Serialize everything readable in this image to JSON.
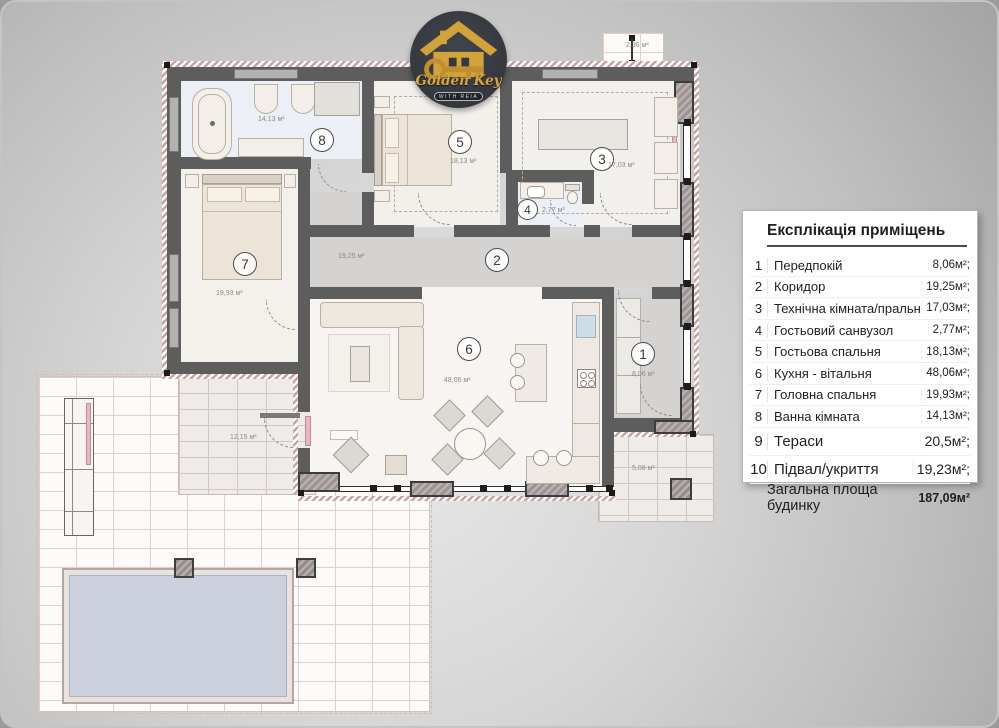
{
  "logo": {
    "brand": "Golden Key",
    "tagline": "WITH REIA"
  },
  "legend": {
    "title": "Експлікація приміщень",
    "rows": [
      {
        "num": "1",
        "name": "Передпокій",
        "area": "8,06м²;"
      },
      {
        "num": "2",
        "name": "Коридор",
        "area": "19,25м²;"
      },
      {
        "num": "3",
        "name": "Технічна кімната/пральна",
        "area": "17,03м²;"
      },
      {
        "num": "4",
        "name": "Гостьовий санвузол",
        "area": "2,77м²;"
      },
      {
        "num": "5",
        "name": "Гостьова спальня",
        "area": "18,13м²;"
      },
      {
        "num": "6",
        "name": "Кухня - вітальня",
        "area": "48,06м²;"
      },
      {
        "num": "7",
        "name": "Головна спальня",
        "area": "19,93м²;"
      },
      {
        "num": "8",
        "name": "Ванна кімната",
        "area": "14,13м²;"
      },
      {
        "num": "9",
        "name": "Тераси",
        "area": "20,5м²;",
        "large": true
      },
      {
        "num": "10",
        "name": "Підвал/укриття",
        "area": "19,23м²;",
        "large": true
      }
    ],
    "total": {
      "label": "Загальна площа будинку",
      "value": "187,09м²"
    }
  },
  "plan": {
    "rooms": [
      {
        "num": "1",
        "area": "8,06 м²"
      },
      {
        "num": "2",
        "area": "19,25 м²"
      },
      {
        "num": "3",
        "area": "17,03 м²"
      },
      {
        "num": "4",
        "area": "2,77 м²"
      },
      {
        "num": "5",
        "area": "18,13 м²"
      },
      {
        "num": "6",
        "area": "48,06 м²"
      },
      {
        "num": "7",
        "area": "19,93 м²"
      },
      {
        "num": "8",
        "area": "14,13 м²"
      }
    ],
    "annotations": {
      "porch": "2,36 м²",
      "covered_terrace": "12,15 м²",
      "entry_terrace": "5,08 м²"
    }
  }
}
